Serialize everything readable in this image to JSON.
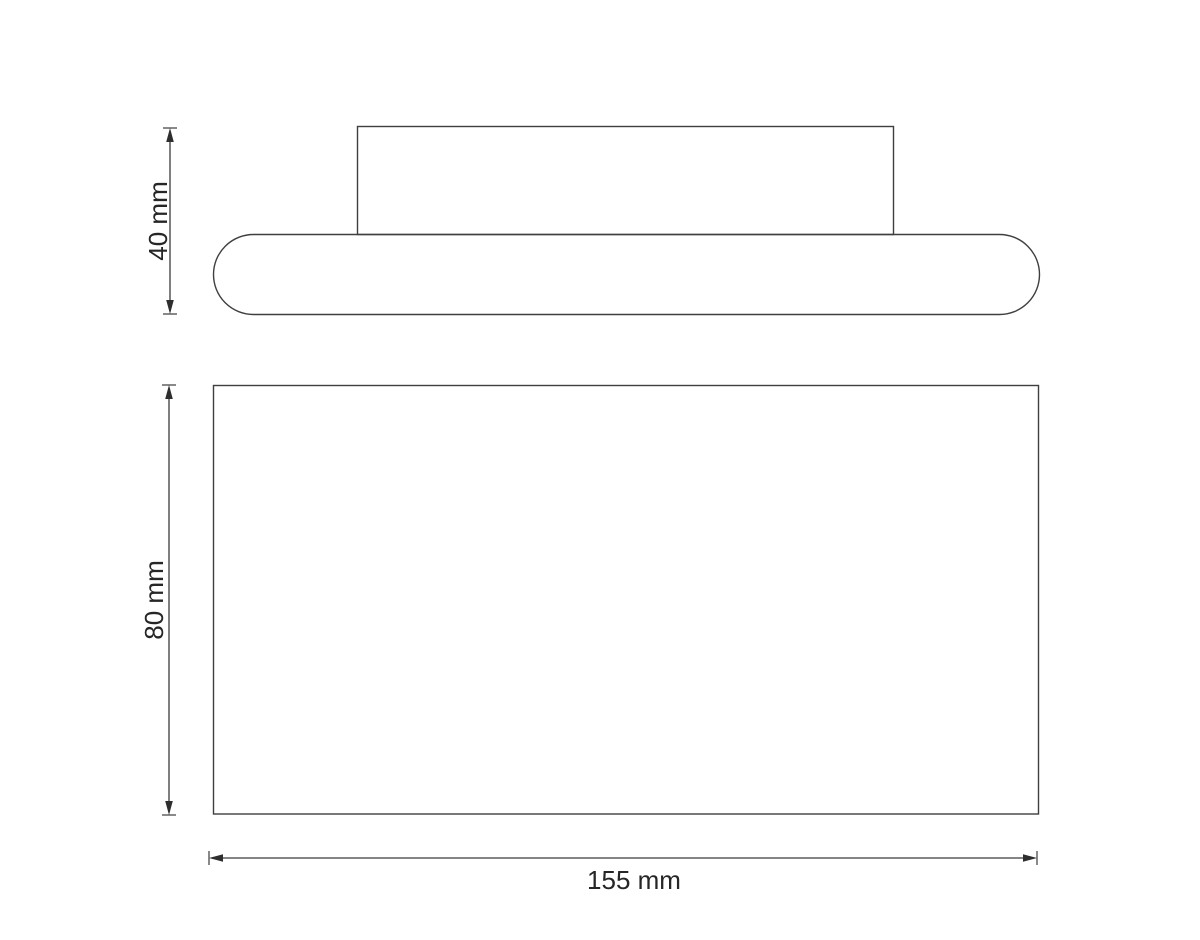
{
  "drawing": {
    "kind": "technical-dimension-drawing",
    "background_color": "#ffffff",
    "line_color": "#3f3f3f",
    "text_color": "#262626",
    "dimensions": {
      "side_height": {
        "label": "40 mm",
        "value": 40,
        "unit": "mm",
        "orientation": "vertical"
      },
      "front_height": {
        "label": "80 mm",
        "value": 80,
        "unit": "mm",
        "orientation": "vertical"
      },
      "front_width": {
        "label": "155 mm",
        "value": 155,
        "unit": "mm",
        "orientation": "horizontal"
      }
    }
  }
}
